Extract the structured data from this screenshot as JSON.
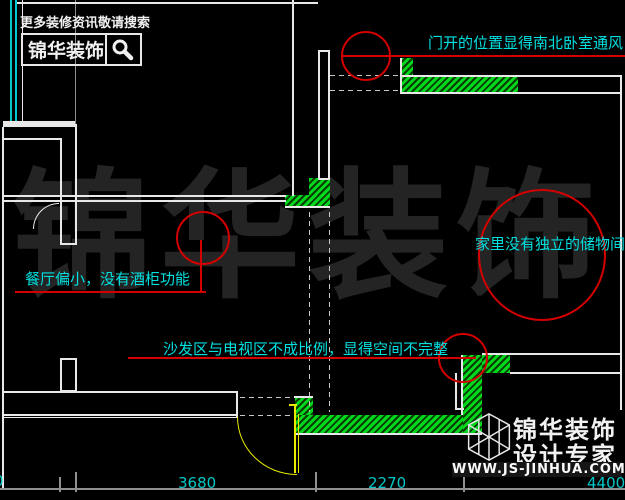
{
  "banner": {
    "tagline": "更多装修资讯敬请搜索",
    "brand": "锦华装饰",
    "icon": "magnifier-search-icon"
  },
  "annotations": {
    "door_vent": "门开的位置显得南北卧室通风",
    "storage": "家里没有独立的储物间",
    "dining": "餐厅偏小，没有酒柜功能",
    "sofa_tv": "沙发区与电视区不成比例，显得空间不完整"
  },
  "watermark": "锦华装饰",
  "badge": {
    "brand": "锦华装饰",
    "tagline": "设计专家",
    "url": "WWW.JS-JINHUA.COM",
    "icon": "cube-logo-icon"
  },
  "dimensions": {
    "left_partial": "0",
    "d1": "3680",
    "d2": "2270",
    "d3": "4400"
  },
  "colors": {
    "background": "#000000",
    "wall_line": "#e8e8e8",
    "hatch_green": "#00d81e",
    "annotation_red": "#d40000",
    "annotation_cyan": "#00e0e0",
    "door_yellow": "#e8e800",
    "dimension_cyan": "#00c8c8",
    "watermark_gray": "#242424"
  }
}
